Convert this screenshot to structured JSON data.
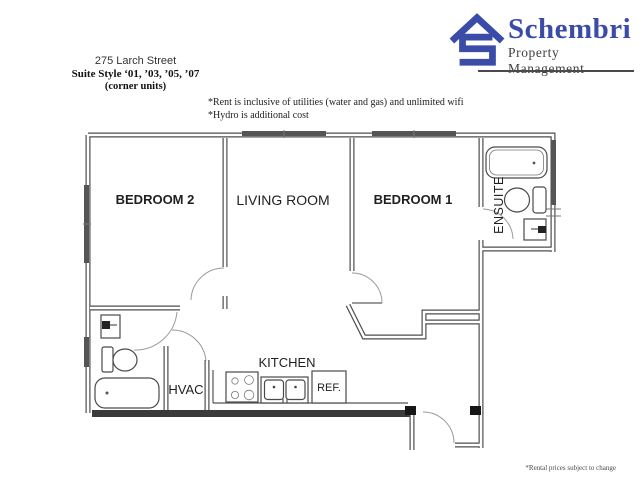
{
  "address": {
    "line1": "275 Larch Street",
    "line2": "Suite Style ‘01, ’03, ’05, ’07",
    "line3": "(corner units)"
  },
  "notes": {
    "line1": "*Rent is inclusive of utilities (water and gas) and unlimited wifi",
    "line2": "*Hydro is additional cost"
  },
  "logo": {
    "name": "Schembri",
    "tagline": "Property Management",
    "accent_color": "#3B4CA8",
    "tagline_color": "#3f3f3f"
  },
  "plan": {
    "bedroom2": "BEDROOM 2",
    "living_room": "LIVING ROOM",
    "bedroom1": "BEDROOM 1",
    "ensuite": "ENSUITE",
    "kitchen": "KITCHEN",
    "hvac": "HVAC",
    "fridge": "REF."
  },
  "footer": {
    "disclaimer": "*Rental prices subject to change"
  }
}
